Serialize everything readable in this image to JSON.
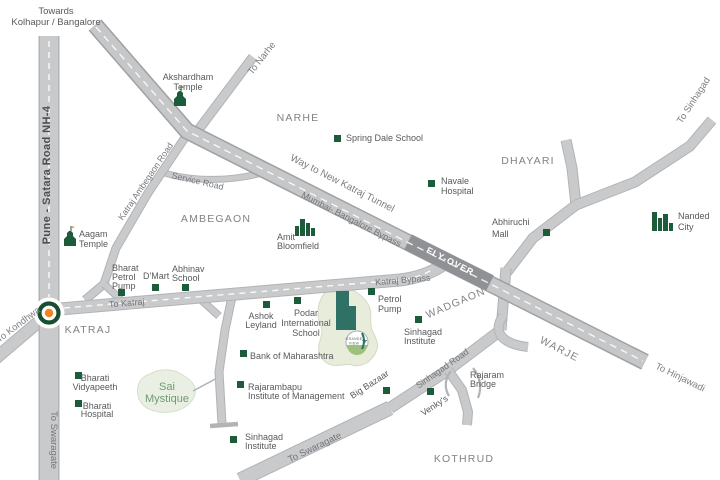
{
  "colors": {
    "road_fill": "#c9cacc",
    "road_edge": "#b2b3b5",
    "flyover_fill": "#8f9194",
    "marker_green": "#1d5c3b",
    "roundabout_ring": "#174f30",
    "roundabout_dot": "#f58220",
    "blob_fill": "#e7ecdb",
    "building_teal": "#2f7265",
    "text_dark": "#58595b",
    "text_area": "#808285"
  },
  "header": {
    "towards_l1": "Towards",
    "towards_l2": "Kolhapur / Bangalore"
  },
  "roads": {
    "nh4": "Pune - Satara Road NH-4",
    "to_swaragate_nh4": "To Swaragate",
    "to_kondhwa": "To Kondhwa",
    "to_katraj": "To Katraj",
    "katraj_bypass": "Katraj Bypass",
    "mumbai_bangalore": "Mumbai- Bangalore Bypass",
    "way_tunnel": "Way to New Katraj Tunnel",
    "flyover": "FLY-OVER",
    "service": "Service Road",
    "katraj_ambegaon": "Katraj Ambegaon Road",
    "to_narhe": "To Narhe",
    "to_sinhagad": "To Sinhagad",
    "sinhagad_road": "Sinhagad Road",
    "to_swaragate": "To Swaragate",
    "to_hinjawadi": "To Hinjawadi"
  },
  "areas": {
    "narhe": "NARHE",
    "dhayari": "DHAYARI",
    "ambegaon": "AMBEGAON",
    "katraj": "KATRAJ",
    "wadgaon": "WADGAON",
    "warje": "WARJE",
    "kothrud": "KOTHRUD"
  },
  "pois": {
    "akshardham_l1": "Akshardham",
    "akshardham_l2": "Temple",
    "spring_dale": "Spring Dale School",
    "navale_l1": "Navale",
    "navale_l2": "Hospital",
    "nanded_l1": "Nanded",
    "nanded_l2": "City",
    "abhiruchi_l1": "Abhiruchi",
    "abhiruchi_l2": "Mall",
    "amit_l1": "Amit",
    "amit_l2": "Bloomfield",
    "aagam_l1": "Aagam",
    "aagam_l2": "Temple",
    "bharat_l1": "Bharat",
    "bharat_l2": "Petrol",
    "bharat_l3": "Pump",
    "dmart": "D'Mart",
    "abhinav_l1": "Abhinav",
    "abhinav_l2": "School",
    "petrol_l1": "Petrol",
    "petrol_l2": "Pump",
    "sinhagad_inst_l1": "Sinhagad",
    "sinhagad_inst_l2": "Institute",
    "sinhagad_inst2_l1": "Sinhagad",
    "sinhagad_inst2_l2": "Institute",
    "ashok_l1": "Ashok",
    "ashok_l2": "Leyland",
    "podar_l1": "Podar",
    "podar_l2": "International",
    "podar_l3": "School",
    "bank": "Bank of Maharashtra",
    "rajarambapu_l1": "Rajarambapu",
    "rajarambapu_l2": "Institute of Management",
    "big_bazaar": "Big Bazaar",
    "venkys": "Venky's",
    "rajaram_bridge_l1": "Rajaram",
    "rajaram_bridge_l2": "Bridge",
    "bharati_vidyapeeth_l1": "Bharati",
    "bharati_vidyapeeth_l2": "Vidyapeeth",
    "bharati_hospital_l1": "Bharati",
    "bharati_hospital_l2": "Hospital"
  },
  "project": {
    "sai_l1": "Sai",
    "sai_l2": "Mystique",
    "logo_l1": "GRANDE",
    "logo_l2": "VIEW",
    "logo_num": "7"
  }
}
